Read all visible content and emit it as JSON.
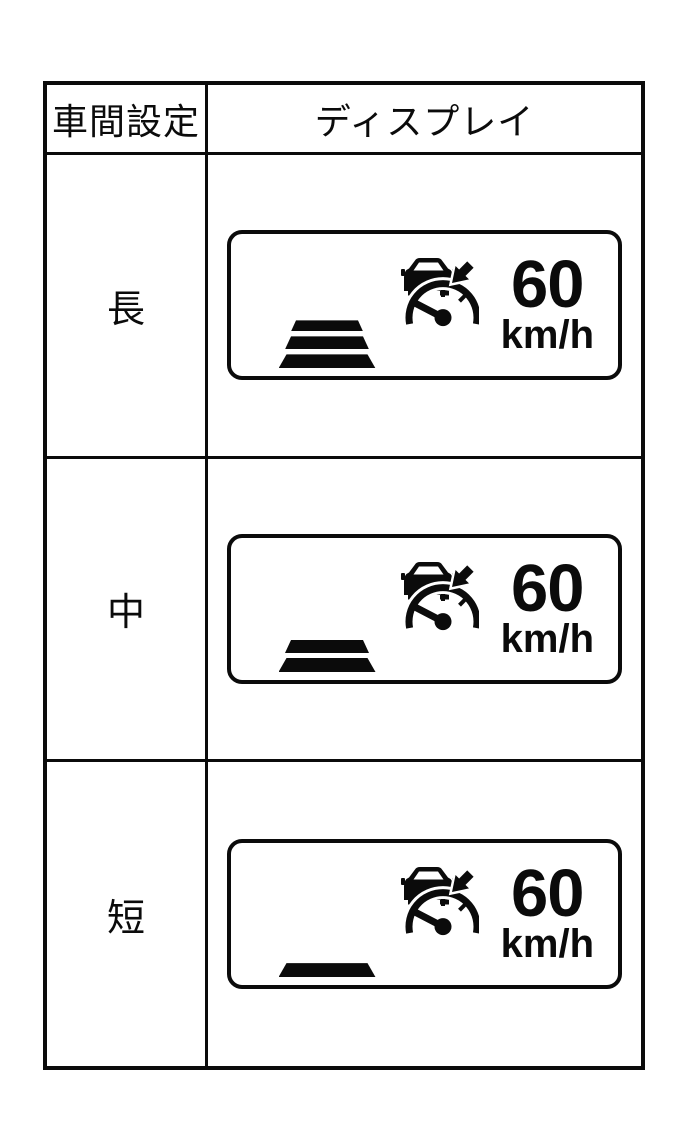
{
  "table": {
    "header": {
      "col1": "車間設定",
      "col2": "ディスプレイ"
    },
    "rows": [
      {
        "setting": "長",
        "speed": "60",
        "unit": "km/h",
        "bars": 3
      },
      {
        "setting": "中",
        "speed": "60",
        "unit": "km/h",
        "bars": 2
      },
      {
        "setting": "短",
        "speed": "60",
        "unit": "km/h",
        "bars": 1
      }
    ]
  },
  "icons": {
    "display_symbol": "adaptive-cruise-control-icon"
  },
  "colors": {
    "foreground": "#0b0b0b",
    "background": "#ffffff"
  }
}
